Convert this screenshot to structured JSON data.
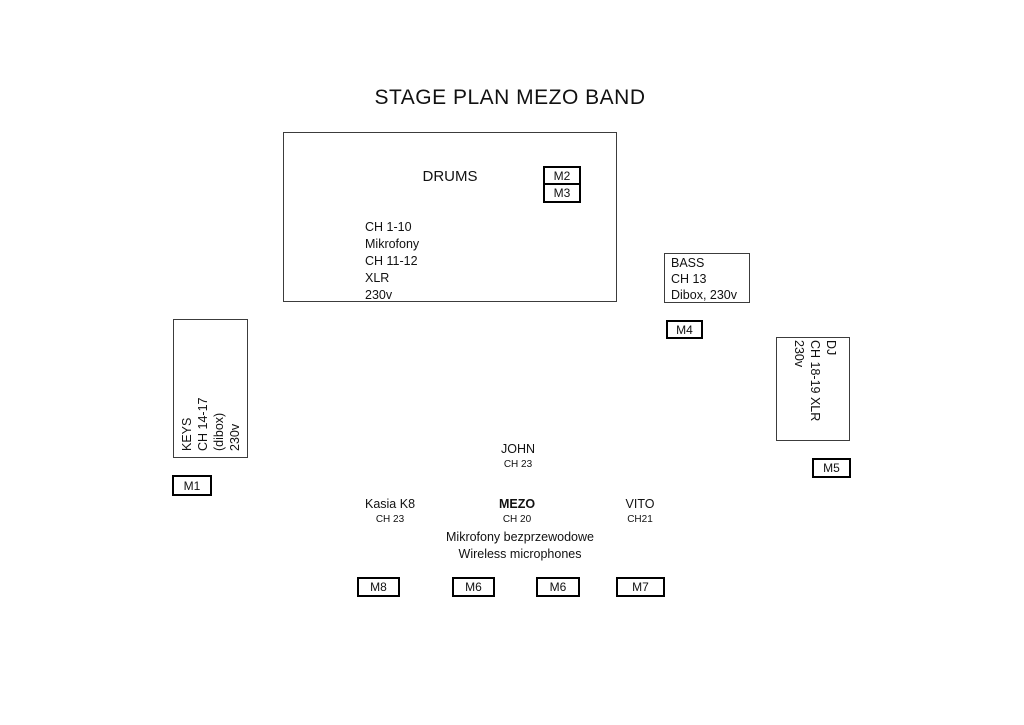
{
  "title": "STAGE PLAN MEZO BAND",
  "drums": {
    "label": "DRUMS",
    "details": "CH  1-10\nMikrofony\nCH  11-12\nXLR\n230v",
    "monitors": [
      "M2",
      "M3"
    ]
  },
  "bass": {
    "details": "BASS\nCH  13\nDibox, 230v",
    "monitor": "M4"
  },
  "keys": {
    "details": "KEYS\nCH 14-17\n(dibox)\n230v",
    "monitor": "M1"
  },
  "dj": {
    "details": "DJ\nCH 18-19 XLR\n230v",
    "monitor": "M5"
  },
  "performers": [
    {
      "name": "JOHN",
      "channel": "CH 23"
    },
    {
      "name": "Kasia K8",
      "channel": "CH 23"
    },
    {
      "name": "MEZO",
      "channel": "CH 20"
    },
    {
      "name": "VITO",
      "channel": "CH21"
    }
  ],
  "wireless_note": {
    "line1": "Mikrofony bezprzewodowe",
    "line2": "Wireless microphones"
  },
  "floor_monitors": [
    "M8",
    "M6",
    "M6",
    "M7"
  ],
  "colors": {
    "background": "#ffffff",
    "line_thin": "#3c3c3c",
    "line_thick": "#000000",
    "text": "#111111"
  }
}
